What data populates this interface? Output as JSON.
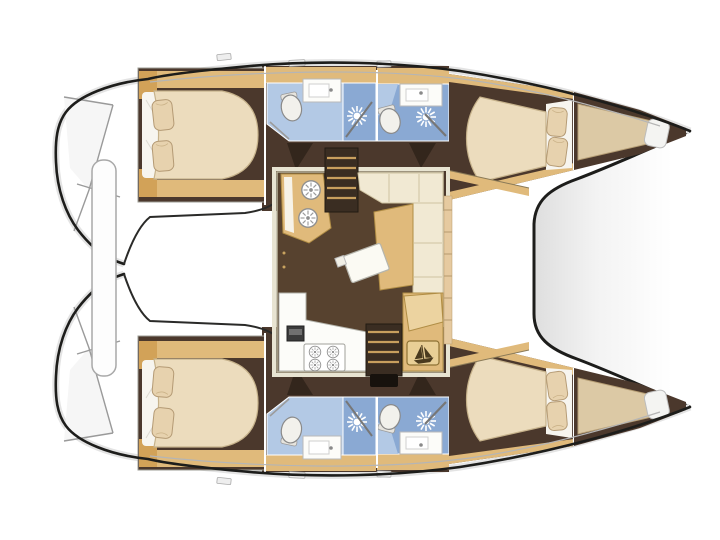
{
  "figure": {
    "kind": "catamaran-interior-floor-plan",
    "view": "top-down",
    "visible_counts": {
      "double_cabins": 4,
      "bathrooms_with_shower": 4,
      "bow_berths": 2,
      "saloons": 1
    }
  },
  "colors": {
    "background": "#ffffff",
    "outline": "#1d1d1b",
    "floor_brown": "#4b382c",
    "floor_brown_dark": "#33261c",
    "saloon_floor": "#57422f",
    "wood_tan": "#e0ba7b",
    "wood_tan_deep": "#d2a258",
    "cream_cushion": "#f1e9d3",
    "cushion_seam": "#cec2a0",
    "mattress_cream": "#ecdcbd",
    "pillow_cream": "#e7d2ae",
    "bed_sheet_white": "#f7f5ef",
    "bath_blue_light": "#b3c9e5",
    "bath_blue_shower": "#8aa9d3",
    "fixture_white": "#f2f1ec",
    "counter_white": "#fcfcf9",
    "berth_tan": "#dcc9a5",
    "tread_tan": "#c89f5e",
    "tramp_shade": "#e0e0e0",
    "icon_dark": "#4a3a1e"
  },
  "icons": {
    "shower_head": "white-sunburst",
    "galley_sink": "ring-with-spokes",
    "stove_burner": "ring-with-spokes",
    "helm_plaque": "sailboat",
    "toilet": "oval-fixture"
  },
  "regions": [
    "aft cabin port",
    "aft bathroom port",
    "forward bathroom port",
    "forward cabin port",
    "bow berth port",
    "aft cabin starboard",
    "aft bathroom starboard",
    "forward bathroom starboard",
    "forward cabin starboard",
    "bow berth starboard",
    "saloon",
    "galley",
    "dinette",
    "navigation seat",
    "stairs to port hull",
    "stairs to starboard hull",
    "cockpit bench",
    "transom steps",
    "foredeck",
    "trampoline"
  ]
}
